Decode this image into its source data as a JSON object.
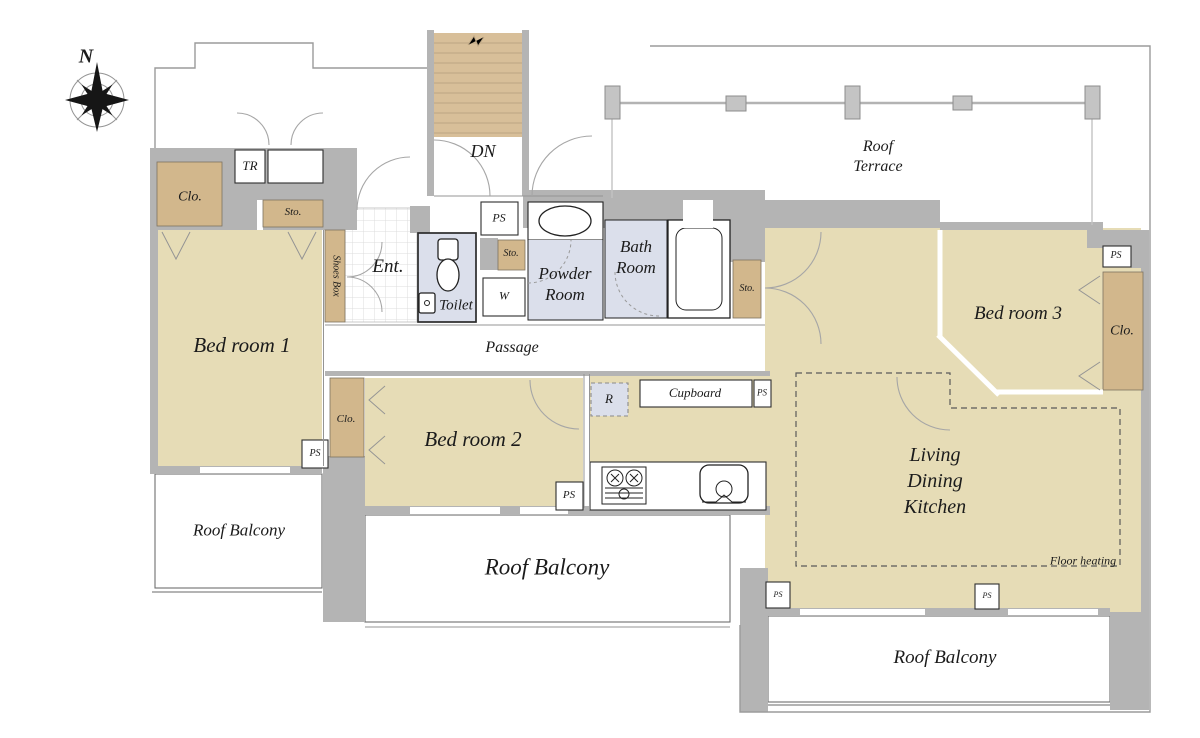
{
  "colors": {
    "wall": "#b4b4b4",
    "floor": "#e6dcb6",
    "closet": "#d2b78c",
    "stairs": "#d8bf99",
    "wet": "#dbdfeb",
    "ink": "#1b1b1b"
  },
  "labels": {
    "compass_n": "N",
    "dn": "DN",
    "roof_terrace_line1": "Roof",
    "roof_terrace_line2": "Terrace",
    "tr": "TR",
    "clo_bedroom1": "Clo.",
    "sto_bedroom1": "Sto.",
    "shoes_box": "Shoes Box",
    "entrance": "Ent.",
    "toilet": "Toilet",
    "ps_hall": "PS",
    "sto_powder": "Sto.",
    "washer": "W",
    "powder_line1": "Powder",
    "powder_line2": "Room",
    "bath_line1": "Bath",
    "bath_line2": "Room",
    "sto_ldk": "Sto.",
    "passage": "Passage",
    "bedroom1": "Bed room 1",
    "bedroom2": "Bed room 2",
    "bedroom3": "Bed room 3",
    "clo_bedroom2": "Clo.",
    "clo_bedroom3": "Clo.",
    "ps_bedroom1": "PS",
    "ps_bedroom2": "PS",
    "ps_bedroom3": "PS",
    "ps_kitchen": "PS",
    "ps_ldk_left": "PS",
    "ps_ldk_right": "PS",
    "refrigerator": "R",
    "cupboard": "Cupboard",
    "ldk_line1": "Living",
    "ldk_line2": "Dining",
    "ldk_line3": "Kitchen",
    "floor_heating": "Floor heating",
    "roof_balcony_left": "Roof Balcony",
    "roof_balcony_center": "Roof Balcony",
    "roof_balcony_bottom": "Roof Balcony"
  }
}
